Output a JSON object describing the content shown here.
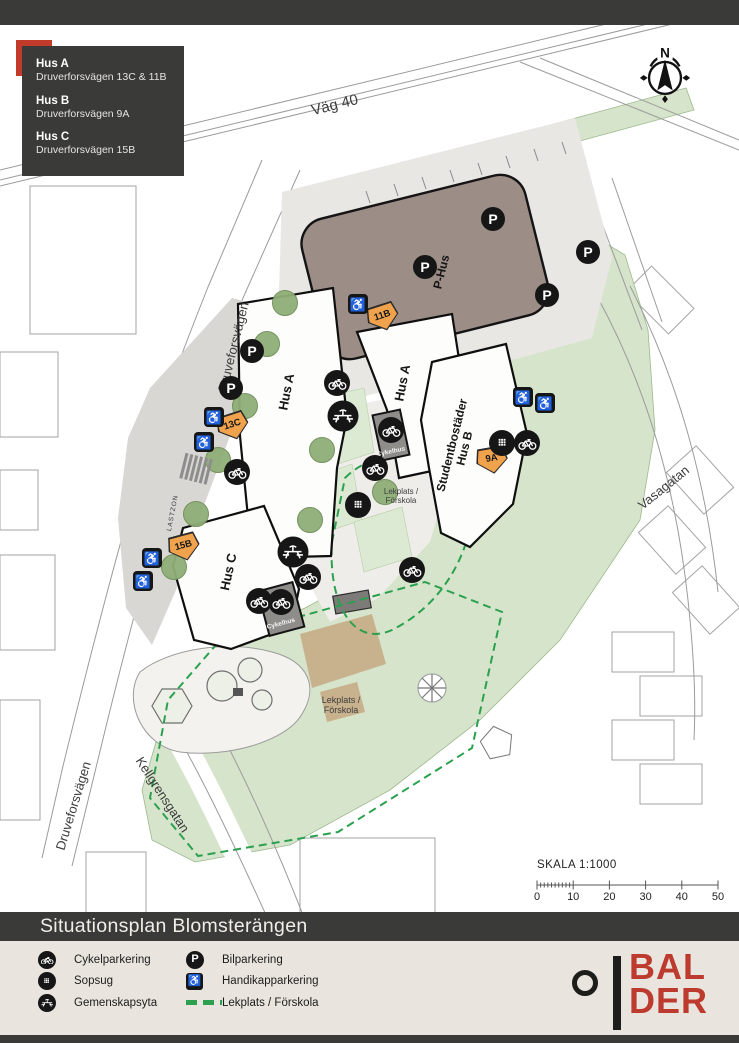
{
  "header_box": {
    "items": [
      {
        "name": "Hus A",
        "address": "Druverforsvägen 13C & 11B"
      },
      {
        "name": "Hus B",
        "address": "Druverforsvägen 9A"
      },
      {
        "name": "Hus C",
        "address": "Druverforsvägen 15B"
      }
    ]
  },
  "compass": {
    "label": "N"
  },
  "map": {
    "labels": [
      {
        "id": "vag-40",
        "text": "Väg 40",
        "x": 335,
        "y": 106,
        "rot": -14,
        "size": 15
      },
      {
        "id": "druveforsvagen-upper",
        "text": "Druveforsvägen",
        "x": 234,
        "y": 347,
        "rot": -76,
        "size": 13
      },
      {
        "id": "druveforsvagen-lower",
        "text": "Druveforsvägen",
        "x": 74,
        "y": 806,
        "rot": -73,
        "size": 13
      },
      {
        "id": "kellgrensgatan",
        "text": "Kellgrensgatan",
        "x": 162,
        "y": 795,
        "rot": 57,
        "size": 13
      },
      {
        "id": "vasagatan",
        "text": "Vasagatan",
        "x": 664,
        "y": 488,
        "rot": -39,
        "size": 13
      },
      {
        "id": "lastzon",
        "text": "LASTZON",
        "x": 173,
        "y": 513,
        "rot": -79,
        "size": 6.5,
        "spacing": 1
      },
      {
        "id": "p-hus",
        "text": "P-Hus",
        "x": 442,
        "y": 272,
        "rot": -76,
        "size": 12,
        "bold": true
      },
      {
        "id": "hus-a-west",
        "text": "Hus A",
        "x": 287,
        "y": 392,
        "rot": -79,
        "size": 13,
        "bold": true
      },
      {
        "id": "hus-a-east",
        "text": "Hus A",
        "x": 403,
        "y": 383,
        "rot": -79,
        "size": 13,
        "bold": true
      },
      {
        "id": "hus-b",
        "text": "Studentbostäder\nHus B",
        "x": 459,
        "y": 447,
        "rot": -76,
        "size": 12,
        "bold": true
      },
      {
        "id": "hus-c",
        "text": "Hus C",
        "x": 229,
        "y": 572,
        "rot": -78,
        "size": 13,
        "bold": true
      },
      {
        "id": "cykelhus-1",
        "text": "Cykelhus",
        "x": 391,
        "y": 452,
        "rot": -12,
        "size": 6.5,
        "light": true
      },
      {
        "id": "cykelhus-2",
        "text": "Cykelhus",
        "x": 281,
        "y": 624,
        "rot": -15,
        "size": 6.5,
        "light": true
      },
      {
        "id": "lekplats-mitt",
        "text": "Lekplats /\nFörskola",
        "x": 401,
        "y": 497,
        "rot": 0,
        "size": 8
      },
      {
        "id": "lekplats-syd",
        "text": "Lekplats /\nFörskola",
        "x": 341,
        "y": 705,
        "rot": 0,
        "size": 9
      }
    ],
    "address_tags": [
      {
        "text": "11B",
        "x": 383,
        "y": 317,
        "rot": -18
      },
      {
        "text": "13C",
        "x": 233,
        "y": 426,
        "rot": -18
      },
      {
        "text": "9A",
        "x": 492,
        "y": 460,
        "rot": -10
      },
      {
        "text": "15B",
        "x": 184,
        "y": 547,
        "rot": -15
      }
    ],
    "marker_defs": {
      "bilparkering": {
        "glyph": "P"
      },
      "handikapparkering": {
        "glyph": "♿"
      },
      "cykelparkering": {},
      "sopsug": {},
      "gemenskapsyta": {}
    },
    "markers": [
      {
        "type": "bilparkering",
        "x": 493,
        "y": 219
      },
      {
        "type": "bilparkering",
        "x": 588,
        "y": 252
      },
      {
        "type": "bilparkering",
        "x": 547,
        "y": 295
      },
      {
        "type": "bilparkering",
        "x": 425,
        "y": 267
      },
      {
        "type": "bilparkering",
        "x": 252,
        "y": 351
      },
      {
        "type": "bilparkering",
        "x": 231,
        "y": 388
      },
      {
        "type": "handikapparkering",
        "x": 358,
        "y": 304
      },
      {
        "type": "handikapparkering",
        "x": 523,
        "y": 397
      },
      {
        "type": "handikapparkering",
        "x": 545,
        "y": 403
      },
      {
        "type": "handikapparkering",
        "x": 214,
        "y": 417
      },
      {
        "type": "handikapparkering",
        "x": 204,
        "y": 442
      },
      {
        "type": "handikapparkering",
        "x": 152,
        "y": 558
      },
      {
        "type": "handikapparkering",
        "x": 143,
        "y": 581
      },
      {
        "type": "cykelparkering",
        "x": 337,
        "y": 383
      },
      {
        "type": "cykelparkering",
        "x": 391,
        "y": 430
      },
      {
        "type": "cykelparkering",
        "x": 375,
        "y": 468
      },
      {
        "type": "cykelparkering",
        "x": 527,
        "y": 443
      },
      {
        "type": "cykelparkering",
        "x": 237,
        "y": 472
      },
      {
        "type": "cykelparkering",
        "x": 308,
        "y": 577
      },
      {
        "type": "cykelparkering",
        "x": 412,
        "y": 570
      },
      {
        "type": "cykelparkering",
        "x": 259,
        "y": 601
      },
      {
        "type": "cykelparkering",
        "x": 281,
        "y": 602
      },
      {
        "type": "sopsug",
        "x": 502,
        "y": 443
      },
      {
        "type": "sopsug",
        "x": 358,
        "y": 505
      },
      {
        "type": "gemenskapsyta",
        "x": 343,
        "y": 416
      },
      {
        "type": "gemenskapsyta",
        "x": 293,
        "y": 552
      }
    ],
    "trees": [
      [
        285,
        303
      ],
      [
        267,
        344
      ],
      [
        245,
        406
      ],
      [
        218,
        460
      ],
      [
        196,
        514
      ],
      [
        174,
        567
      ],
      [
        322,
        450
      ],
      [
        310,
        520
      ],
      [
        385,
        492
      ]
    ]
  },
  "scale": {
    "title": "SKALA 1:1000",
    "ticks": [
      "0",
      "10",
      "20",
      "30",
      "40",
      "50"
    ]
  },
  "title_bar": {
    "title": "Situationsplan Blomsterängen"
  },
  "legend": {
    "items_left": [
      {
        "icon": "cykelparkering",
        "label": "Cykelparkering"
      },
      {
        "icon": "sopsug",
        "label": "Sopsug"
      },
      {
        "icon": "gemenskapsyta",
        "label": "Gemenskapsyta"
      }
    ],
    "items_right": [
      {
        "icon": "bilparkering",
        "label": "Bilparkering"
      },
      {
        "icon": "handikapparkering",
        "label": "Handikapparkering"
      },
      {
        "icon": "lekplats",
        "label": "Lekplats / Förskola"
      }
    ]
  },
  "logo": {
    "line1": "BAL",
    "line2": "DER"
  },
  "colors": {
    "accent_red": "#c23a2a",
    "balder_red": "#bd3a2e",
    "bar_dark": "#3a3a38",
    "legend_bg": "#e9e5de",
    "green_area": "#d6e4cb",
    "dashed_green": "#2ba14f",
    "phus_fill": "#9c8d86",
    "cykelhus_fill": "#8f8d8a",
    "tag_orange": "#f0a24c",
    "tree_green": "#8fae78"
  }
}
